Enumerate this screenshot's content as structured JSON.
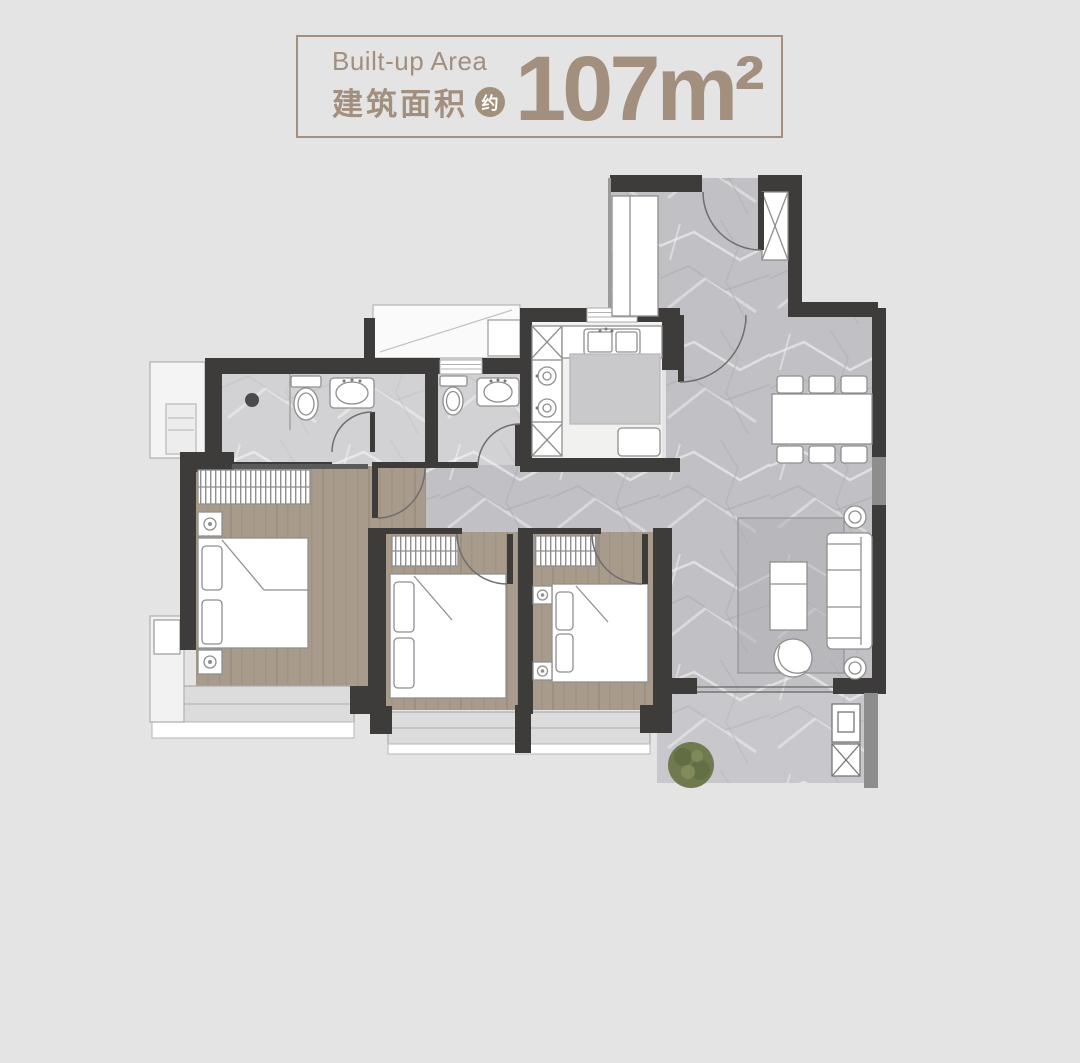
{
  "title_card": {
    "label_en": "Built-up Area",
    "label_zh": "建筑面积",
    "approx_badge": "约",
    "area_value": "107",
    "area_unit": "m²"
  },
  "colors": {
    "accent_taupe": "#a28f7e",
    "background": "#e4e4e4",
    "wall_dark": "#3e3c3b",
    "wall_medium": "#8d8d8d",
    "tile_gray": "#c1c1c5",
    "bedroom_floor": "#a89b8b",
    "kitchen_floor": "#f1f1ef",
    "balcony_gray": "#dcdcdc",
    "plant_green": "#6f7a4e"
  },
  "floorplan": {
    "rooms": [
      "foyer",
      "dining-living",
      "hallway",
      "kitchen",
      "bathroom-1",
      "bathroom-2",
      "master-bedroom",
      "bedroom-2",
      "bedroom-3",
      "balcony",
      "bay-windows",
      "ac-platforms",
      "utility-nook"
    ],
    "fixtures": [
      "entry-door",
      "shoe-cabinet",
      "coat-closet",
      "kitchen-sink",
      "stove",
      "island-counter",
      "fridge",
      "dining-table",
      "dining-chairs",
      "sofa",
      "coffee-table",
      "rug",
      "side-tables",
      "accent-chair",
      "toilets",
      "wash-basins",
      "shower-drain",
      "wardrobes",
      "beds",
      "nightstands",
      "plant",
      "water-heater",
      "washer-unit"
    ]
  }
}
